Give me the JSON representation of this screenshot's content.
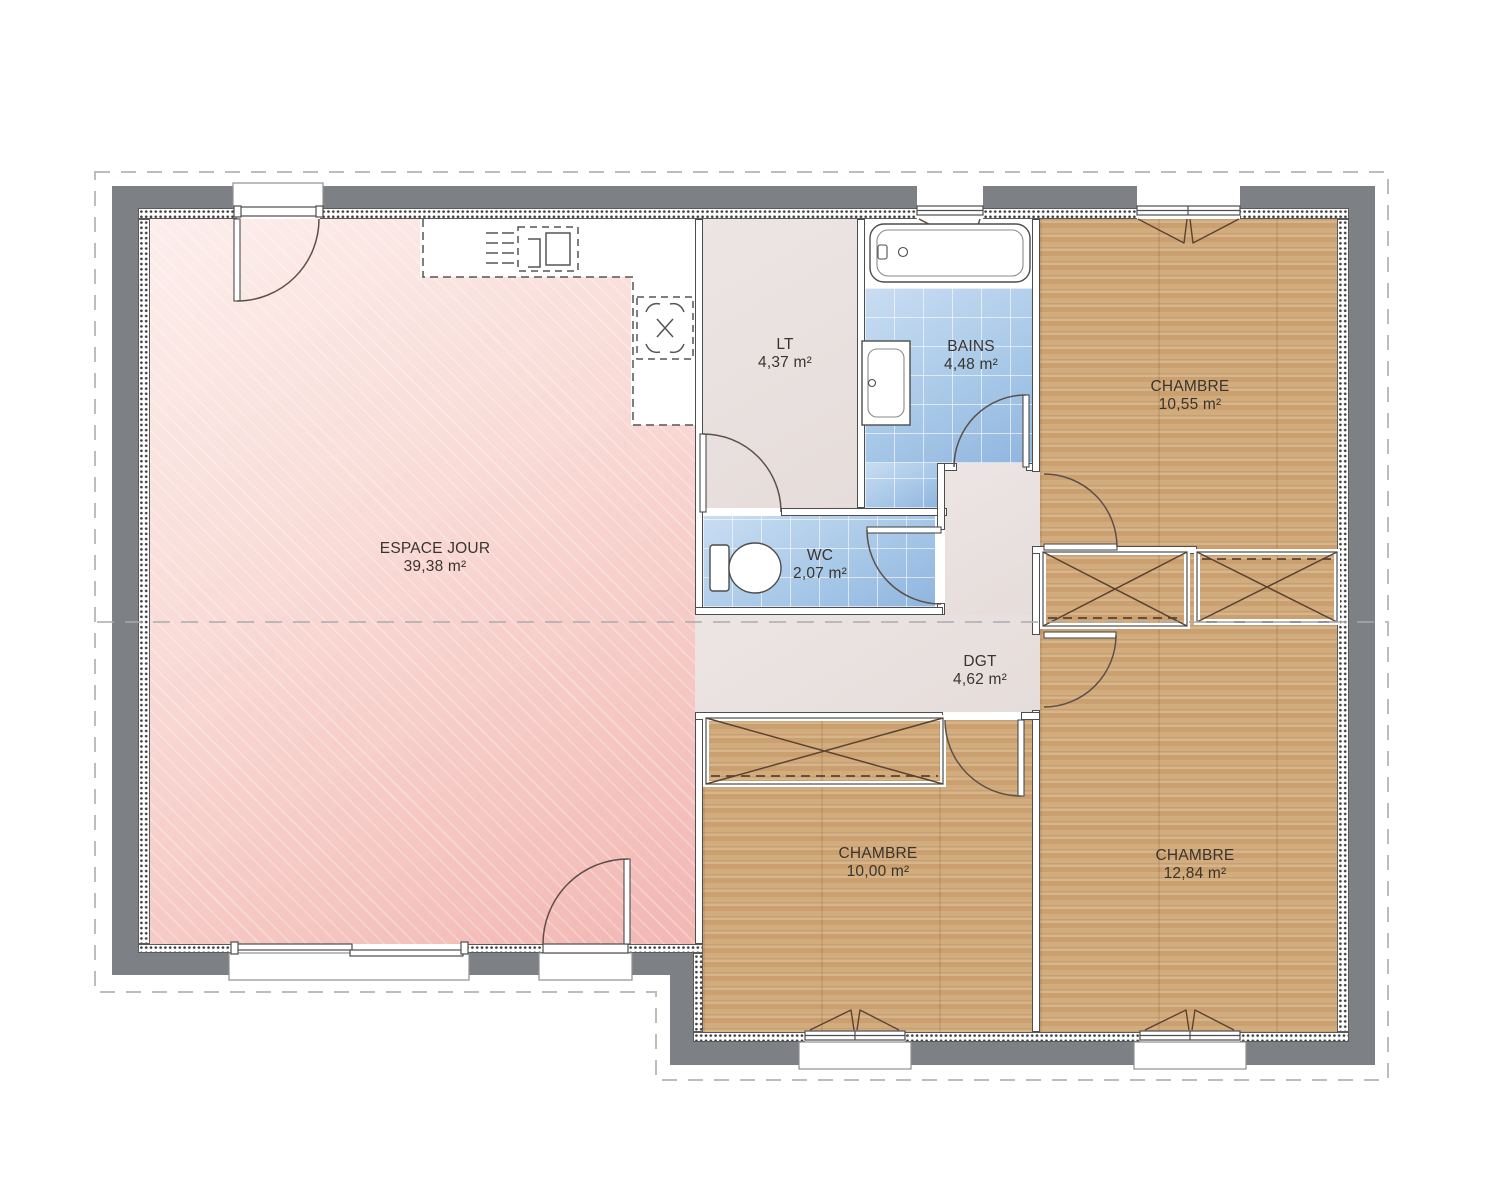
{
  "plan": {
    "rooms": [
      {
        "id": "espace-jour",
        "label": "ESPACE JOUR",
        "area": "39,38 m²"
      },
      {
        "id": "lt",
        "label": "LT",
        "area": "4,37 m²"
      },
      {
        "id": "bains",
        "label": "BAINS",
        "area": "4,48 m²"
      },
      {
        "id": "chambre-1",
        "label": "CHAMBRE",
        "area": "10,55 m²"
      },
      {
        "id": "wc",
        "label": "WC",
        "area": "2,07 m²"
      },
      {
        "id": "dgt",
        "label": "DGT",
        "area": "4,62 m²"
      },
      {
        "id": "chambre-2",
        "label": "CHAMBRE",
        "area": "10,00 m²"
      },
      {
        "id": "chambre-3",
        "label": "CHAMBRE",
        "area": "12,84 m²"
      }
    ],
    "colors": {
      "wall-gray": "#7d8185",
      "wood-floor": "#d1a877",
      "tile-blue": "#aac9e8",
      "living-pink": "#f2b7b3",
      "corridor-beige": "#e9e2e0",
      "line-dark": "#5b4330",
      "label-text": "#3a342e"
    }
  }
}
